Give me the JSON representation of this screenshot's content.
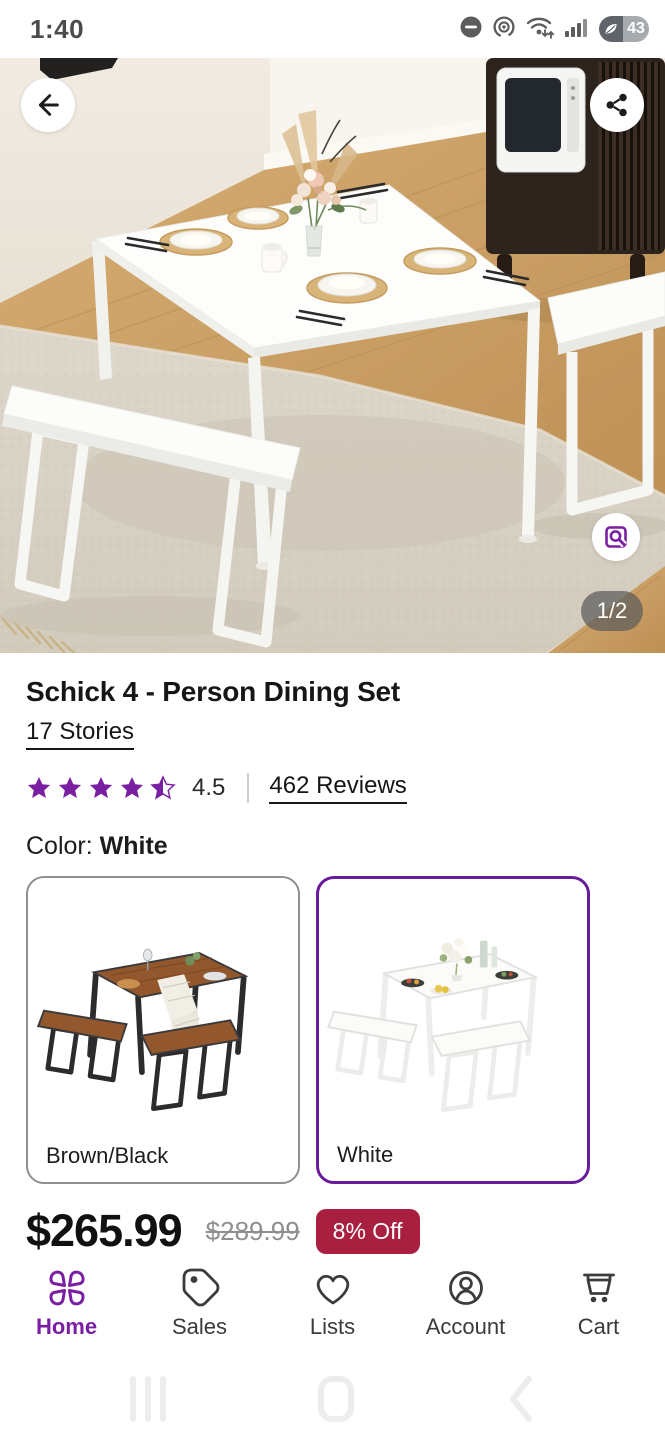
{
  "status_bar": {
    "time": "1:40",
    "battery_level": "43",
    "icons": [
      "do-not-disturb-icon",
      "screen-record-icon",
      "wifi-icon",
      "signal-icon",
      "battery-saver-icon"
    ]
  },
  "gallery": {
    "page_indicator": "1/2",
    "buttons": [
      "back",
      "share",
      "image-search"
    ]
  },
  "product": {
    "title": "Schick 4 - Person Dining Set",
    "brand": "17 Stories",
    "rating_value": "4.5",
    "rating_stars": 4.5,
    "reviews_label": "462 Reviews",
    "color_label": "Color:",
    "selected_color": "White",
    "options": [
      {
        "label": "Brown/Black",
        "selected": false
      },
      {
        "label": "White",
        "selected": true
      }
    ],
    "price": "$265.99",
    "original_price": "$289.99",
    "discount_label": "8% Off"
  },
  "colors": {
    "accent_purple": "#7b1fa2",
    "swatch_selected_border": "#6a1b9a",
    "discount_red": "#a81f3f"
  },
  "bottom_nav": {
    "items": [
      {
        "label": "Home",
        "icon": "home-logo-icon",
        "active": true
      },
      {
        "label": "Sales",
        "icon": "tag-icon",
        "active": false
      },
      {
        "label": "Lists",
        "icon": "heart-icon",
        "active": false
      },
      {
        "label": "Account",
        "icon": "account-icon",
        "active": false
      },
      {
        "label": "Cart",
        "icon": "cart-icon",
        "active": false
      }
    ]
  }
}
